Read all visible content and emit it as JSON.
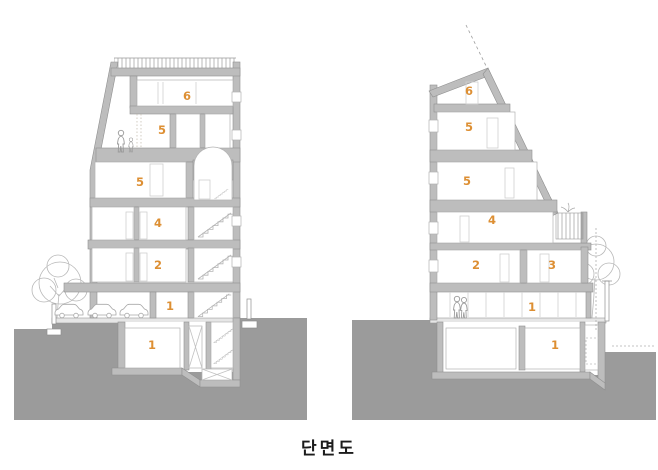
{
  "title": "단면도",
  "colors": {
    "background": "#ffffff",
    "ground": "#9b9b9b",
    "wall": "#bdbdbd",
    "wall_outline": "#8f8f8f",
    "accent_number": "#dd8f33",
    "light_line": "#c9c9c9",
    "title_text": "#1c1c1c"
  },
  "left_section": {
    "name": "left building section",
    "floor_labels": [
      "6",
      "5",
      "5",
      "4",
      "2",
      "1",
      "1"
    ]
  },
  "right_section": {
    "name": "right building section",
    "floor_labels": [
      "6",
      "5",
      "5",
      "4",
      "2",
      "3",
      "1",
      "1"
    ]
  }
}
